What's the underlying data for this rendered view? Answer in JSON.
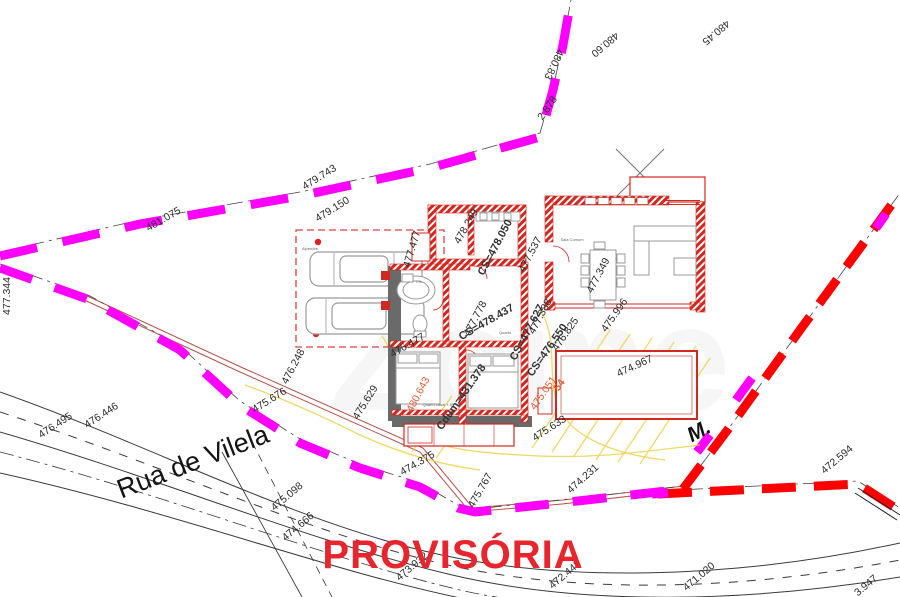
{
  "drawing": {
    "title": "PROVISÓRIA",
    "street_name": "Rua de Vilela",
    "north_marker": "M.",
    "watermark": "Zome",
    "rooms": [
      "Alpendre",
      "Sala Comum",
      "Quarto",
      "Quarto casal + IS",
      "I.S."
    ],
    "elevations": [
      "481.075",
      "479.743",
      "479.150",
      "2.878",
      "480.83",
      "480.60",
      "480.45",
      "477.344",
      "476.248",
      "475.676",
      "475.629",
      "476.495",
      "476.446",
      "475.098",
      "474.666",
      "473.932",
      "472.442",
      "471.020",
      "3.947",
      "472.594",
      "474.375",
      "475.767",
      "474.231",
      "475.633",
      "478.249",
      "477.477",
      "477.537",
      "477.349",
      "477.778",
      "476.477",
      "477.388",
      "476.825",
      "475.996",
      "474.967"
    ],
    "thresholds": [
      "CS=478.050",
      "CS=478.437",
      "CS=477.627",
      "CS=476.550",
      "Cdum=431.378"
    ],
    "red_marks": [
      "480.643",
      "475.051",
      "54"
    ],
    "colors": {
      "boundary_magenta": "#ff00ff",
      "boundary_red": "#ff0000",
      "wall_red": "#d2281f",
      "existing_gray": "#6a6a6a",
      "contour_yellow": "#ecd34c",
      "title_red": "#e8242c"
    }
  }
}
